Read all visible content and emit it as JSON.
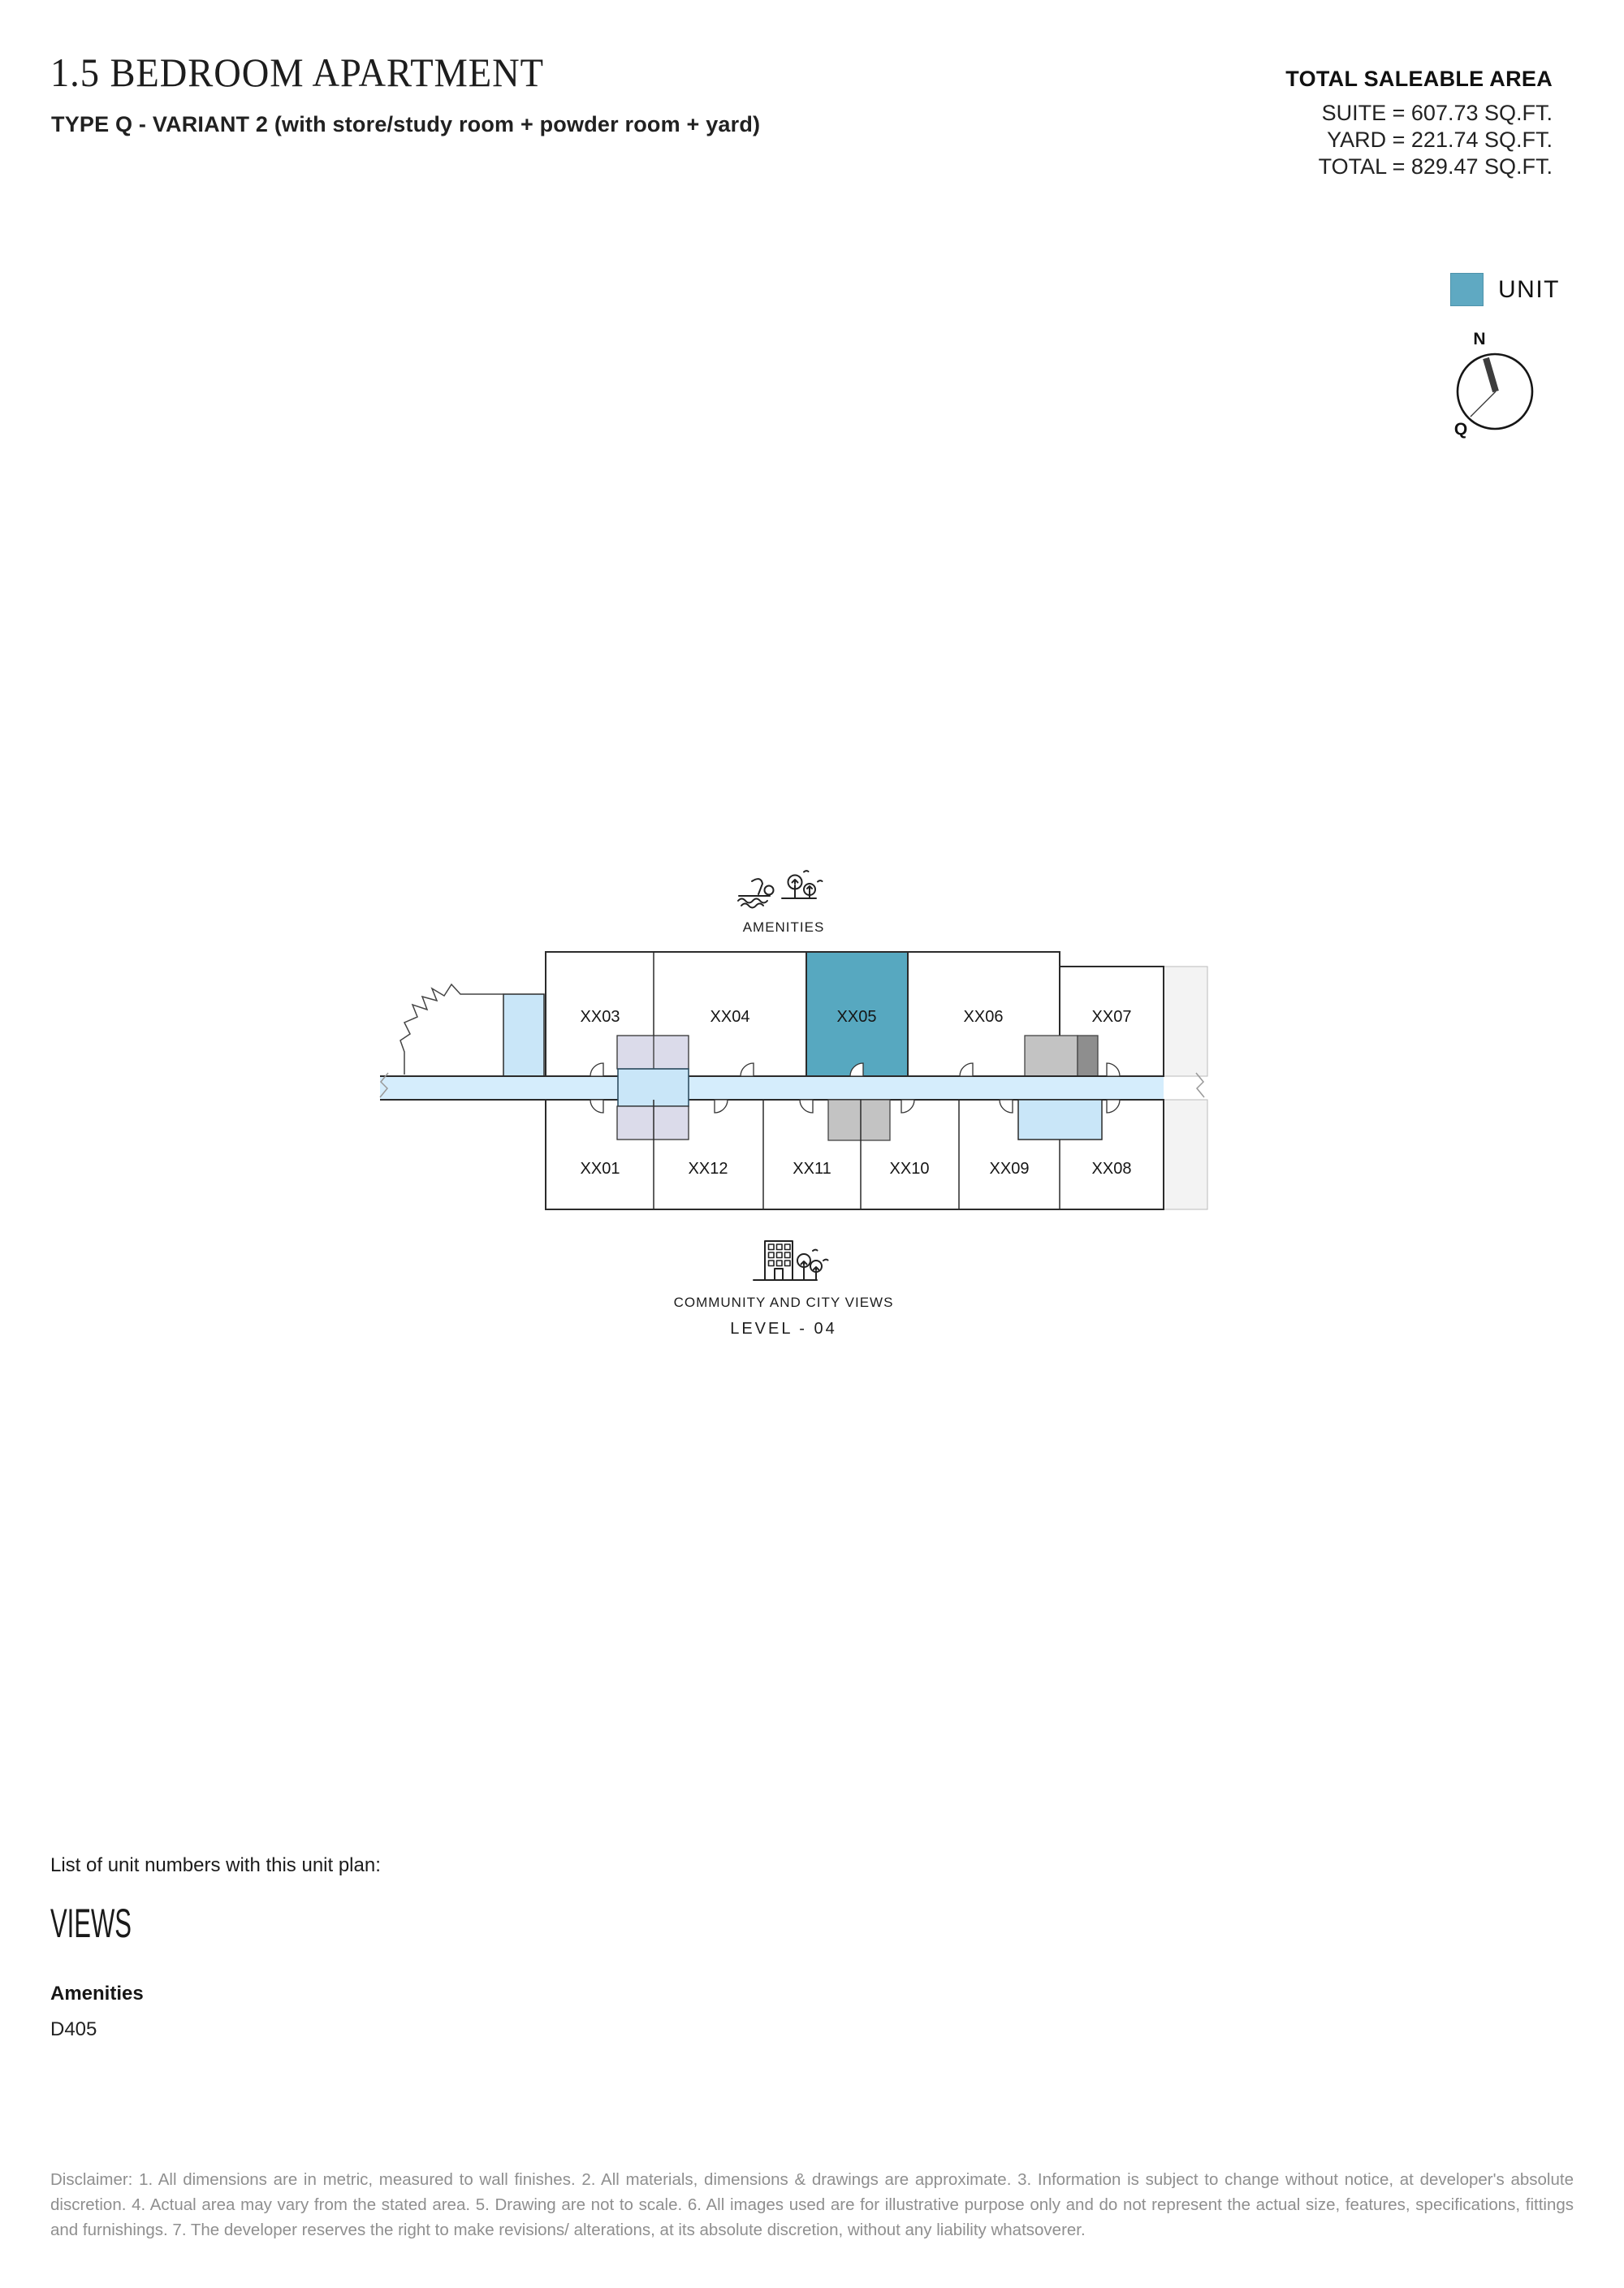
{
  "header": {
    "title": "1.5 BEDROOM APARTMENT",
    "subtitle": "TYPE Q - VARIANT 2 (with store/study room + powder room + yard)"
  },
  "saleable_area": {
    "heading": "TOTAL SALEABLE AREA",
    "suite": "SUITE = 607.73 SQ.FT.",
    "yard": "YARD = 221.74 SQ.FT.",
    "total": "TOTAL = 829.47 SQ.FT."
  },
  "legend": {
    "label": "UNIT",
    "color": "#5FA9C2"
  },
  "compass": {
    "north": "N",
    "pointer": "Q"
  },
  "floor_plan": {
    "captions": {
      "top": "AMENITIES",
      "bottom": "COMMUNITY AND CITY VIEWS",
      "level": "LEVEL - 04"
    },
    "highlighted_unit": "XX05",
    "top_row_units": [
      "XX03",
      "XX04",
      "XX05",
      "XX06",
      "XX07"
    ],
    "bottom_row_units": [
      "XX01",
      "XX12",
      "XX11",
      "XX10",
      "XX09",
      "XX08"
    ],
    "colors": {
      "unit_fill": "#57A8C0",
      "corridor": "#D5EDFC",
      "lobby": "#C9E6F8",
      "core": "#DBDBEA",
      "service": "#C3C3C3",
      "service_dark": "#8E8E8E",
      "stair": "#C9E6F8",
      "strip": "#F3F3F3"
    }
  },
  "unit_list": {
    "intro": "List of unit numbers with this unit plan:",
    "heading": "VIEWS",
    "group_label": "Amenities",
    "group_units": "D405"
  },
  "disclaimer": "Disclaimer: 1. All dimensions are in metric, measured to wall finishes. 2. All materials, dimensions & drawings are approximate. 3. Information is subject to change without notice, at developer's absolute discretion. 4. Actual area may vary from the stated area. 5. Drawing are not to scale. 6. All images used are for illustrative purpose only and do not represent the actual size, features, specifications, fittings and furnishings. 7. The developer reserves the right to make revisions/ alterations, at its absolute discretion, without any liability whatsoverer."
}
